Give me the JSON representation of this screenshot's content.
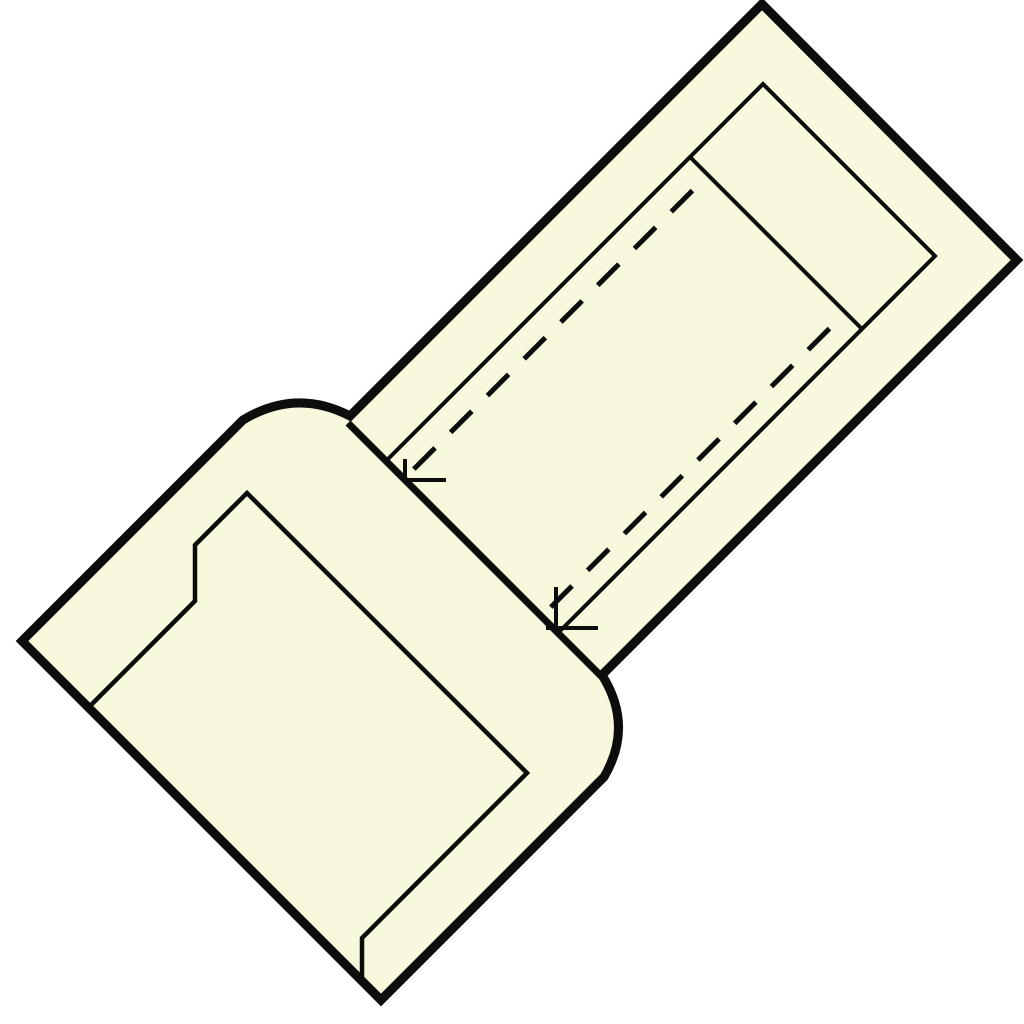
{
  "figure": {
    "name": "butt-splice-connector-line-drawing"
  },
  "colors": {
    "background": "#ffffff",
    "body_fill": "#f8f9dc",
    "line": "#0d0d0d",
    "none": "none"
  },
  "strokes": {
    "outer_width": "9",
    "inner_width": "4",
    "step_width": "7",
    "face_width": "4.5",
    "cap_width": "4",
    "tick_width": "4",
    "bore_width": "5",
    "bore_dash_pattern": "30 22",
    "bore_dash_offset": "30"
  }
}
